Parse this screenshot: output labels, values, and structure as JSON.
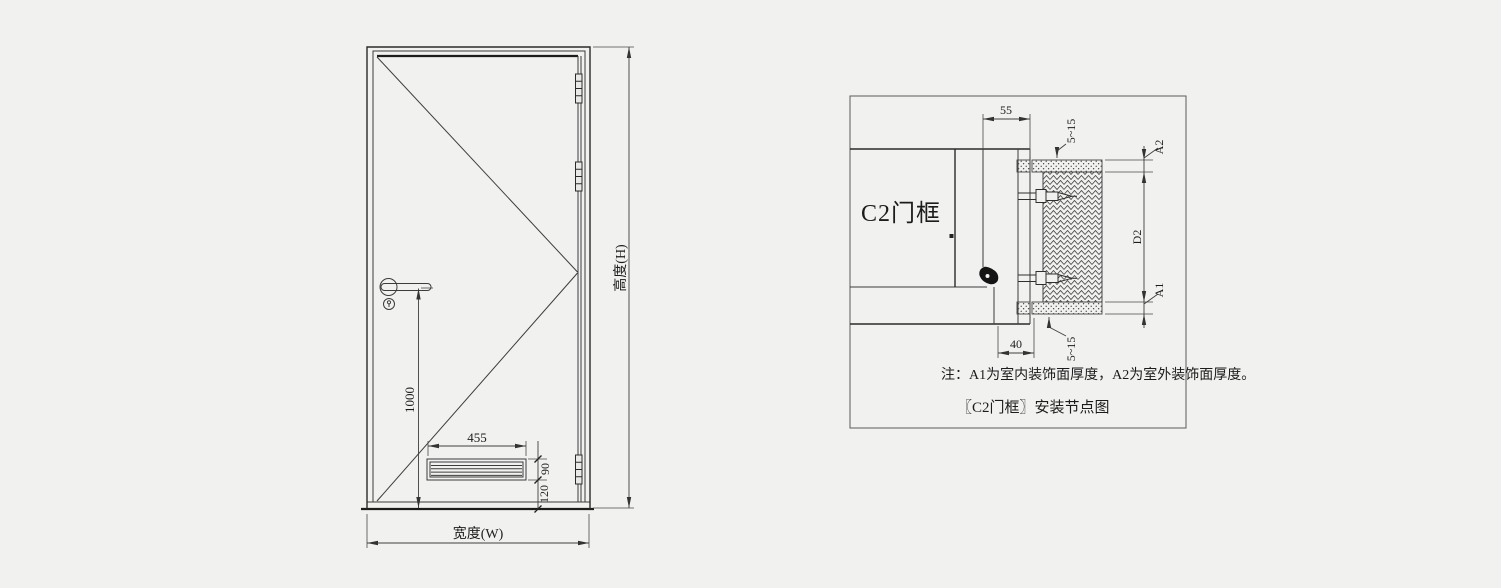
{
  "colors": {
    "background": "#f1f1ef",
    "line": "#3c3c3c",
    "line_dark": "#1c1c1c",
    "text": "#1c1c1c"
  },
  "door_elevation": {
    "width_dim_label": "宽度(W)",
    "height_dim_label": "高度(H)",
    "handle_height_dim": "1000",
    "louver_width_dim": "455",
    "louver_height_dim": "90",
    "louver_bottom_dim": "120"
  },
  "frame_detail": {
    "frame_label": "C2门框",
    "frame_face_width_dim": "55",
    "frame_throat_dim": "40",
    "gap_top_dim": "5~15",
    "gap_bottom_dim": "5~15",
    "outdoor_finish_dim": "A2",
    "wall_thickness_dim": "D2",
    "indoor_finish_dim": "A1",
    "note": "注：A1为室内装饰面厚度，A2为室外装饰面厚度。",
    "caption": "〖C2门框〗安装节点图"
  }
}
